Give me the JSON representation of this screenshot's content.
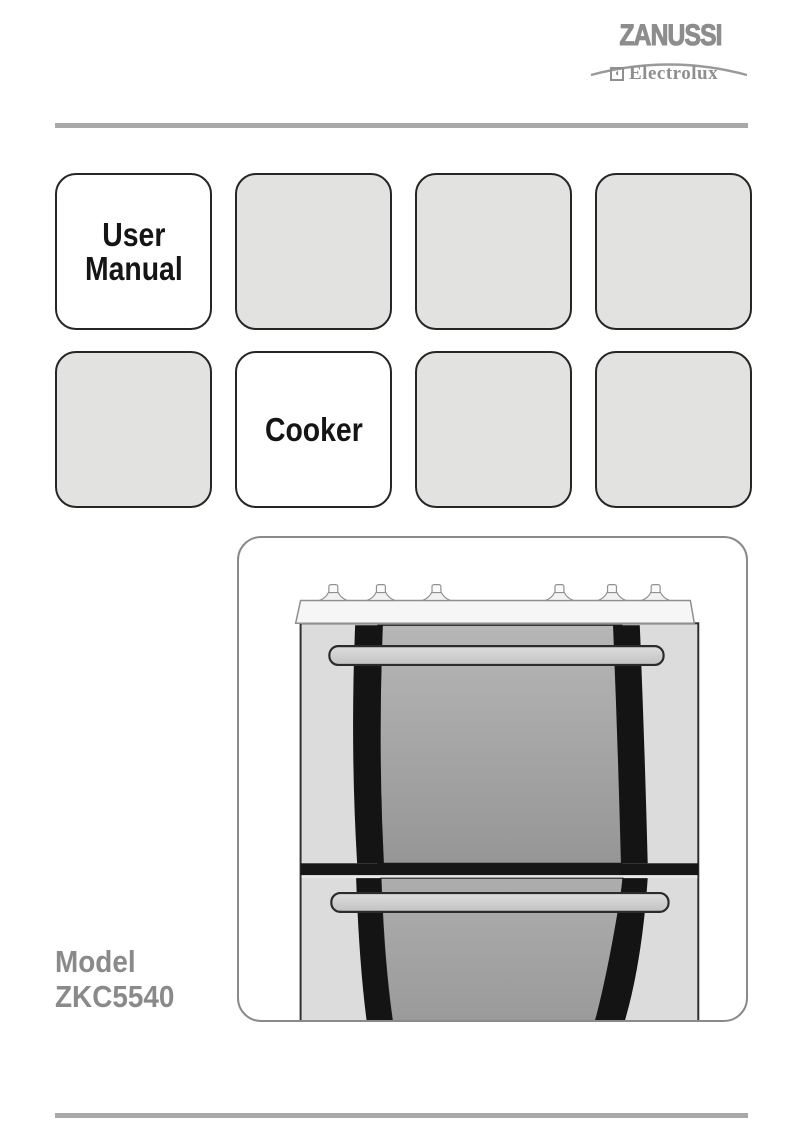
{
  "brand": {
    "zanussi": "ZANUSSI",
    "electrolux": "Electrolux"
  },
  "icons": {
    "electrolux_symbol": "◖"
  },
  "tiles": [
    {
      "lines": [
        "User",
        "Manual"
      ],
      "highlighted": true
    },
    {
      "lines": [],
      "highlighted": false
    },
    {
      "lines": [],
      "highlighted": false
    },
    {
      "lines": [],
      "highlighted": false
    },
    {
      "lines": [],
      "highlighted": false
    },
    {
      "lines": [
        "Cooker"
      ],
      "highlighted": true
    },
    {
      "lines": [],
      "highlighted": false
    },
    {
      "lines": [],
      "highlighted": false
    }
  ],
  "model": {
    "label": "Model",
    "number": "ZKC5540"
  },
  "illustration": {
    "description": "Front view of a double-oven cooker with six hob control knobs and two door handles"
  },
  "colors": {
    "logo_gray": "#8d8d8d",
    "banner_gray": "#a9a9a9",
    "rule_gray": "#a9a9a9",
    "tile_fill": "#e2e2e0",
    "tile_border": "#262626",
    "tile_text": "#151515",
    "model_gray": "#8a8a8a",
    "door_black": "#141414",
    "glass_gray": "#a3a3a3"
  }
}
